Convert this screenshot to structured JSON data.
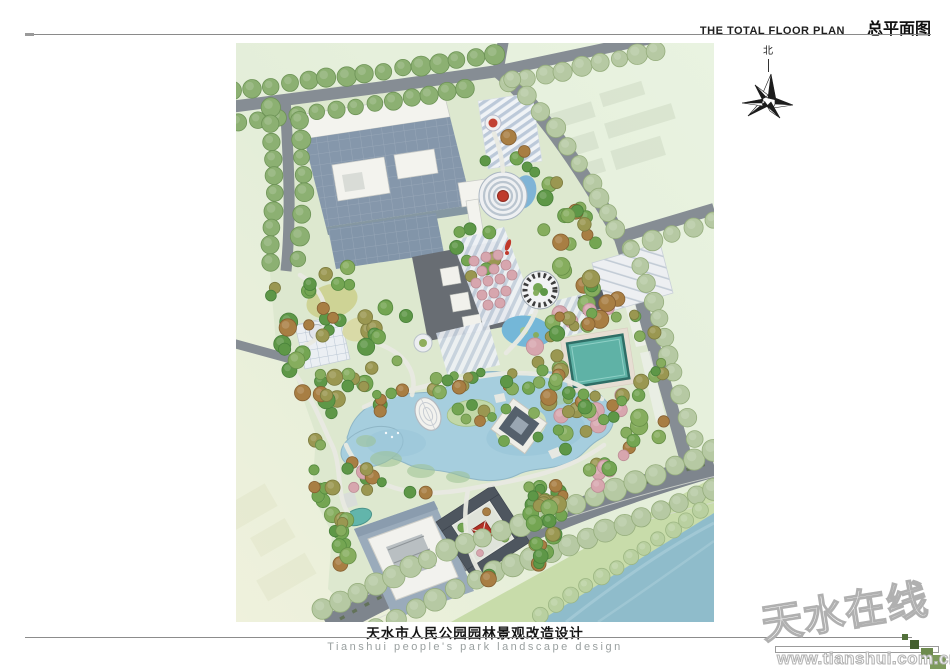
{
  "header": {
    "title_en": "THE TOTAL FLOOR PLAN",
    "title_zh": "总平面图"
  },
  "north_arrow": {
    "label": "北"
  },
  "footer": {
    "title_zh": "天水市人民公园园林景观改造设计",
    "subtitle_en": "Tianshui people's park landscape design"
  },
  "watermark": {
    "site_name": "天水在线",
    "site_url": "www.tianshui.com.cn"
  },
  "plan_colors": {
    "background": "#e4eed9",
    "park_ground": "#dde8cf",
    "road": "#868d94",
    "lake": "#a6cede",
    "swimming_pool": "#5fb2a6",
    "river": "#8fbccb",
    "river_bank": "#c8dcaa",
    "roof_blue": "#8597ab",
    "dark_building": "#686d73",
    "courtyard_roof": "#4e565f",
    "red_accent": "#bf3a2b",
    "tree_green": "#74a552",
    "tree_sage": "#b6c9a3",
    "tree_pink": "#d7a6ae",
    "watermark_green": "#6d8a4d"
  }
}
